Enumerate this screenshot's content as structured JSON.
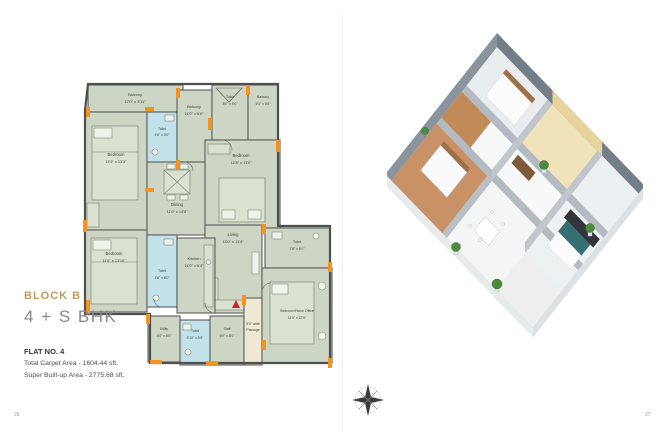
{
  "page": {
    "left_number": "26",
    "right_number": "27"
  },
  "info": {
    "block": "BLOCK B",
    "unit_type": "4 + S BHK",
    "flat_no": "FLAT NO. 4",
    "carpet_area": "Total Carpet Area - 1604.44 sft.",
    "builtup_area": "Super Built-up Area - 2775.68 sft."
  },
  "floorplan": {
    "rooms": [
      {
        "label": "Balcony",
        "dims": "17'0\" x 3'11\""
      },
      {
        "label": "Bedroom",
        "dims": "11'0\" x 13'3\""
      },
      {
        "label": "Toilet",
        "dims": "4'6\" x 8'0\""
      },
      {
        "label": "Balcony",
        "dims": "11'0\" x 8'0\""
      },
      {
        "label": "Toilet",
        "dims": "8'0\" x 5'0\""
      },
      {
        "label": "Balcony",
        "dims": "5'1\" x 5'5\""
      },
      {
        "label": "Bedroom",
        "dims": "12'8\" x 11'0\""
      },
      {
        "label": "Dining",
        "dims": "11'0\" x 14'8\""
      },
      {
        "label": "Living",
        "dims": "13'0\" x 14'9\""
      },
      {
        "label": "Bedroom",
        "dims": "11'0\" x 13'10\""
      },
      {
        "label": "Toilet",
        "dims": "4'6\" x 8'0\""
      },
      {
        "label": "Kitchen",
        "dims": "11'0\" x 8'3\""
      },
      {
        "label": "Utility",
        "dims": "5'0\" x 8'0\""
      },
      {
        "label": "Toilet",
        "dims": "5'10\" x 5'9\""
      },
      {
        "label": "Staff",
        "dims": "6'0\" x 8'0\""
      },
      {
        "label": "Toilet",
        "dims": "7'8\" x 5'0\""
      },
      {
        "label": "Bedroom/Home Office",
        "dims": "11'0\" x 12'0\""
      },
      {
        "label": "5'0\" wide",
        "dims": "Passage"
      }
    ],
    "colors": {
      "plan_green": "#cdd6c4",
      "toilet_blue": "#c2e1ea",
      "wall_gray": "#4f4f4f",
      "accent_orange": "#f6921e",
      "passage_cream": "#efe8d2",
      "title_tan": "#c49a62",
      "entry_red": "#cc2a1e"
    }
  }
}
